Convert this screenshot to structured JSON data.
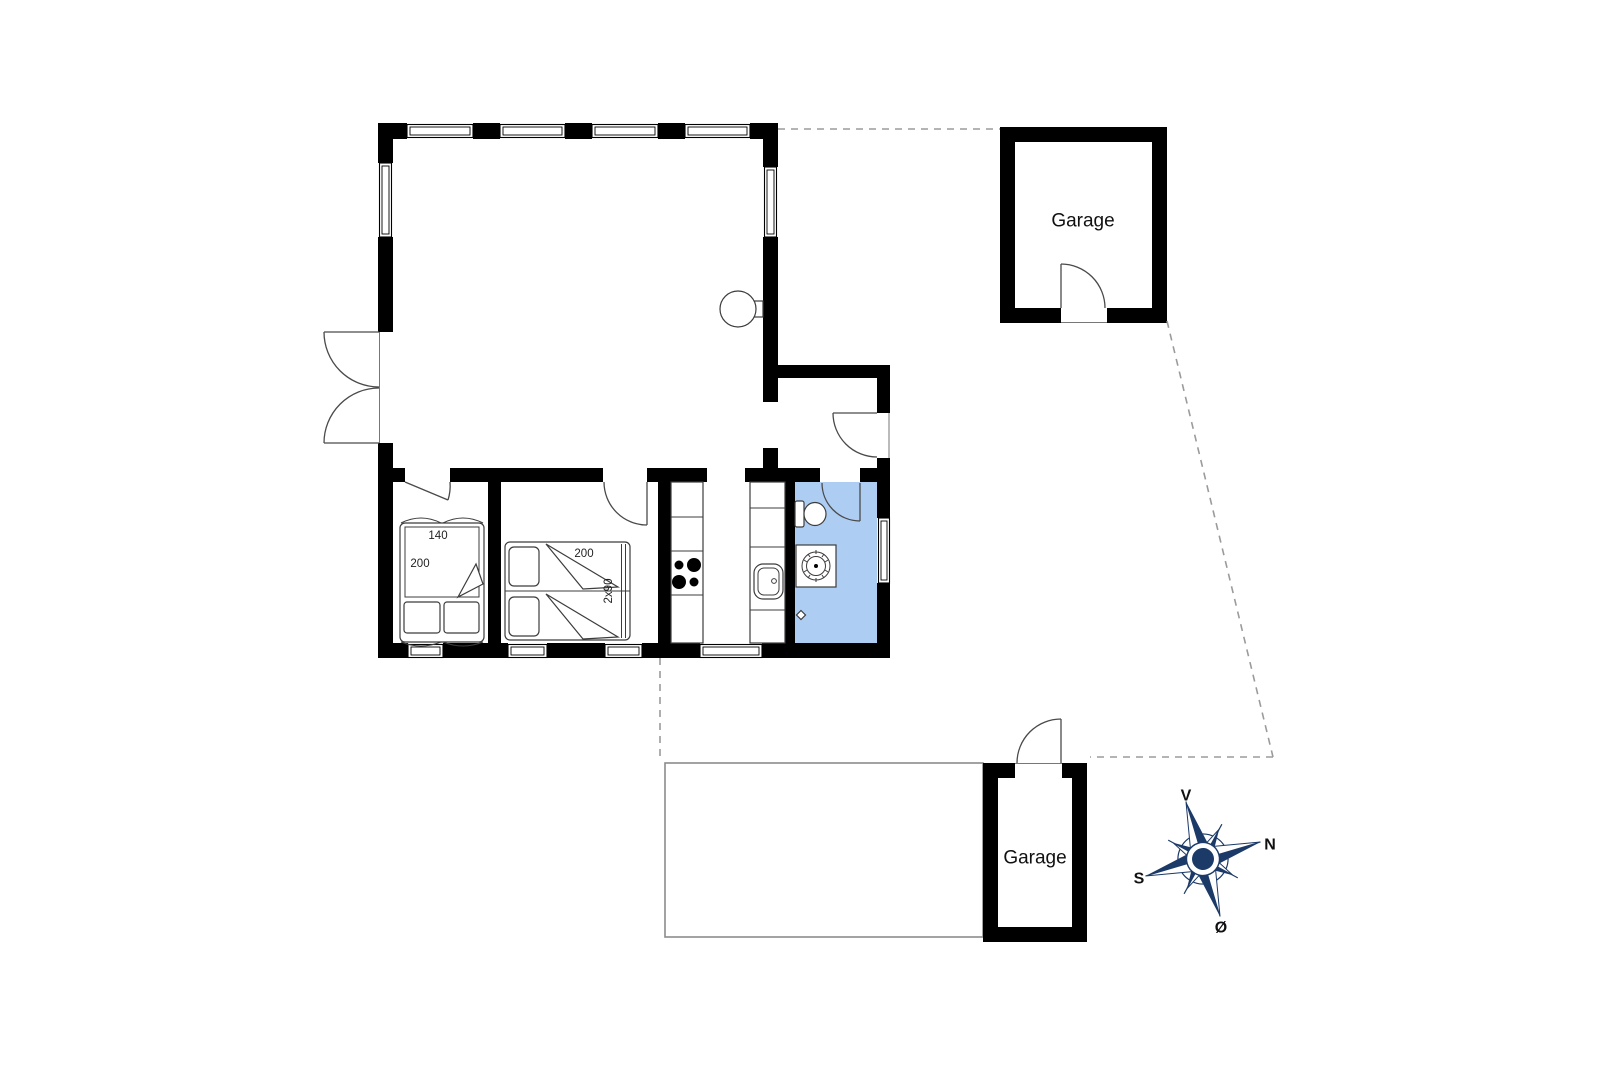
{
  "plan": {
    "colors": {
      "bathroom_fill": "#aecdf3",
      "wall_color": "#000000",
      "furniture_line": "#3c3c3c",
      "property_dash": "#9b9b9b",
      "compass_color": "#1c3a68"
    },
    "labels": {
      "garage_top": "Garage",
      "garage_bottom": "Garage",
      "bed1_width": "140",
      "bed1_length": "200",
      "bed2_length": "200",
      "bed2_size": "2x90"
    },
    "compass": {
      "west": "V",
      "north": "N",
      "south": "S",
      "east": "Ø"
    }
  }
}
